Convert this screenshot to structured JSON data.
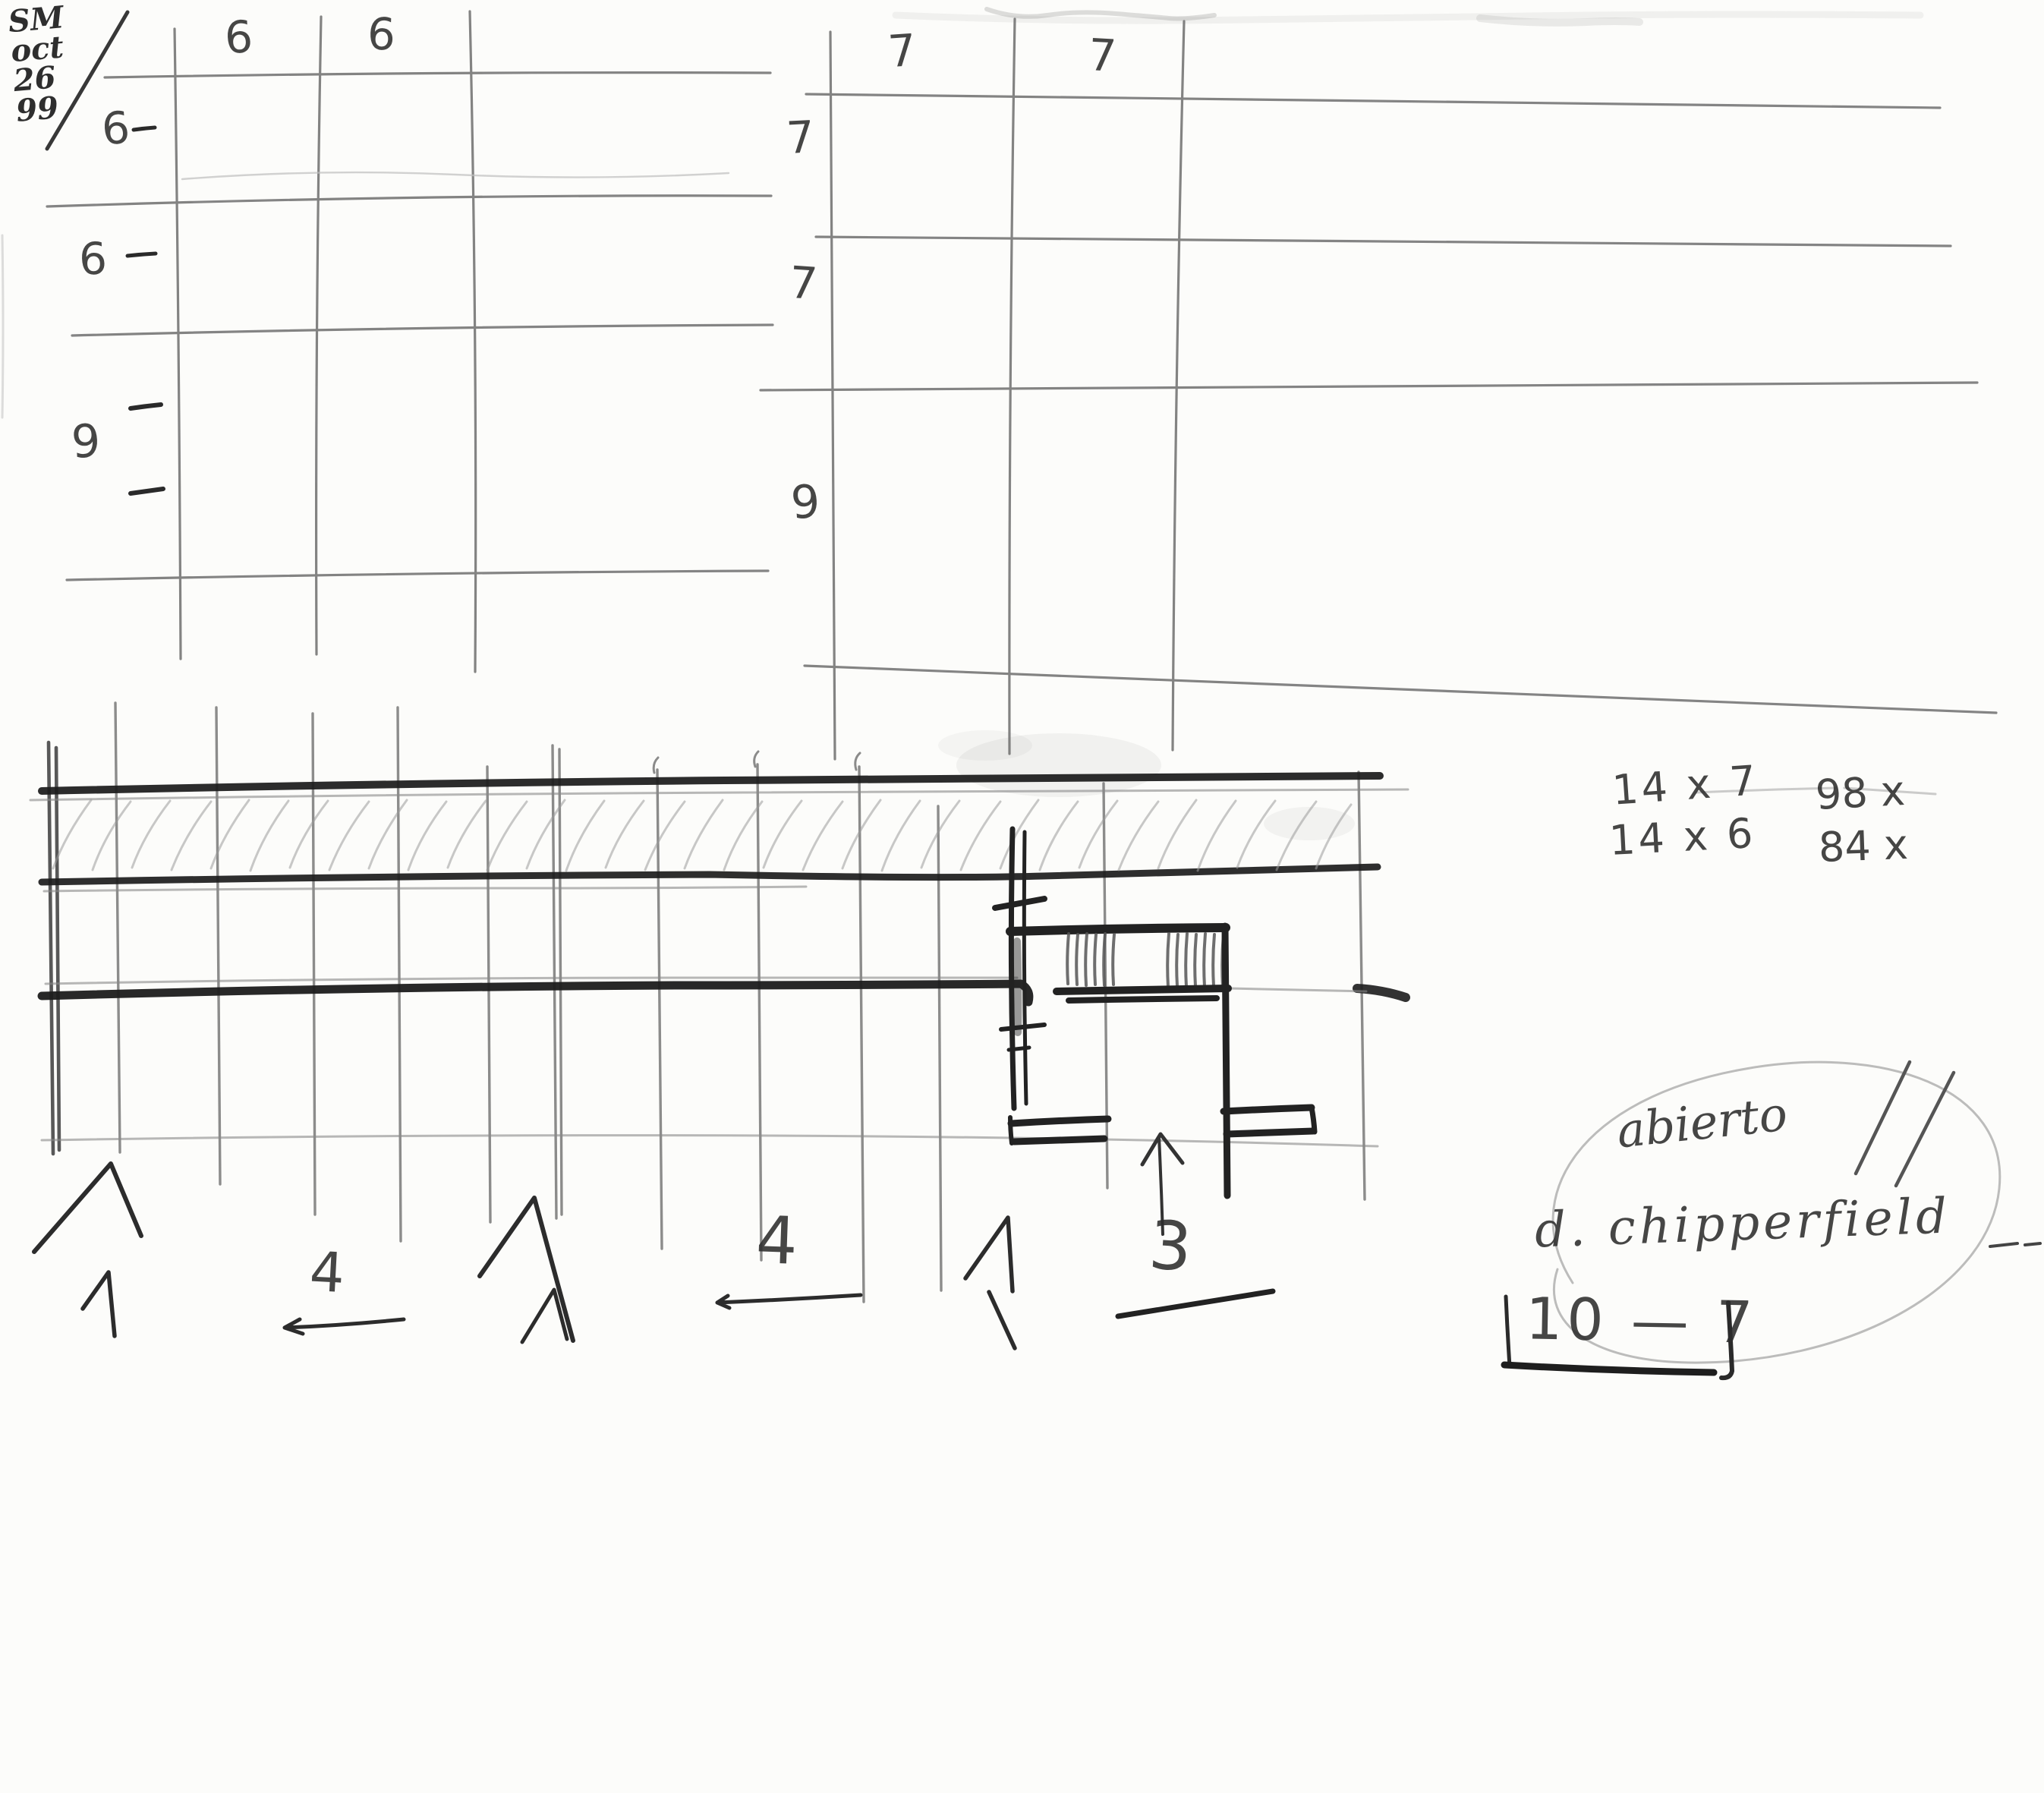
{
  "meta": {
    "description": "Scanned hand-drawn pencil sketch (architectural study)",
    "paper_color": "#fcfcfa",
    "pencil_dark": "#1f1f1f",
    "pencil_mid": "#555555",
    "pencil_light": "#9a9a9a"
  },
  "date_block": {
    "day": "SM",
    "month": "oct",
    "date": "26",
    "year": "99"
  },
  "left_grid": {
    "col_labels": [
      "6",
      "6"
    ],
    "row_labels": [
      "6",
      "6",
      "9"
    ]
  },
  "right_grid": {
    "col_labels": [
      "7",
      "7"
    ],
    "row_labels": [
      "7",
      "7",
      "9"
    ]
  },
  "calculations": {
    "row1_expr": "14 x 7",
    "row1_result": "98 x",
    "row2_expr": "14 x 6",
    "row2_result": "84 x"
  },
  "bottom_row": {
    "four_left": "4",
    "four_right": "4",
    "three": "3"
  },
  "notes": {
    "abierto": "abierto",
    "architect": "d. chipperfield",
    "hours": "10 — 7"
  }
}
